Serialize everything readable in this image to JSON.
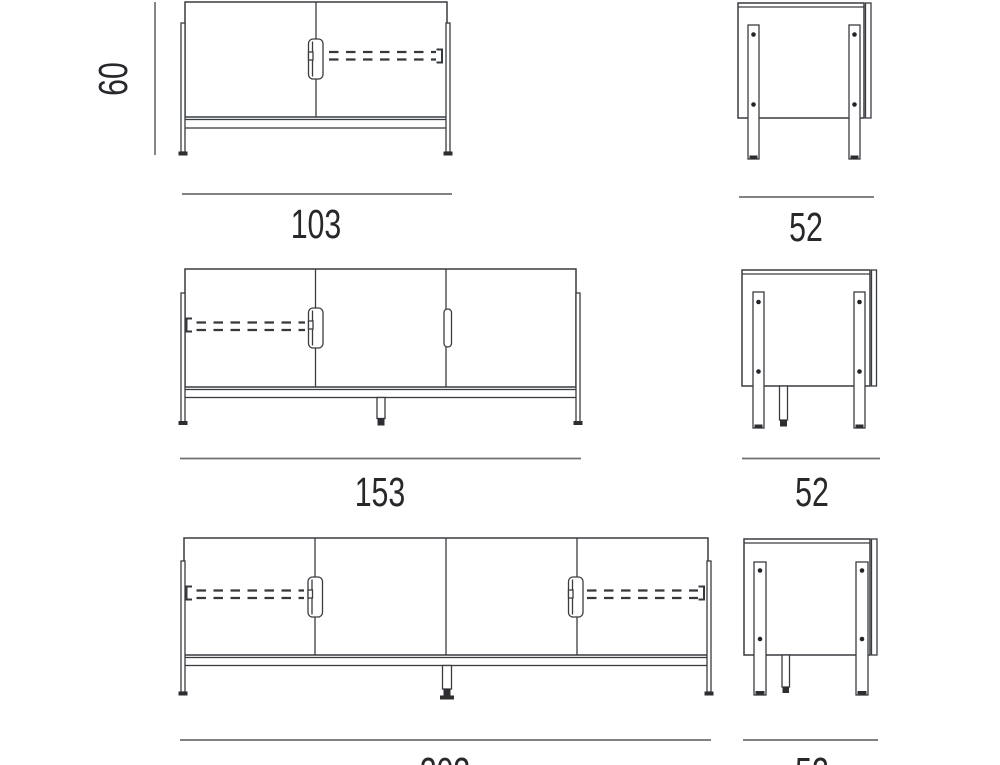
{
  "page": {
    "background": "#ffffff",
    "line_color": "#393c41",
    "dimension_line_color": "#6e7174",
    "text_color": "#26282c"
  },
  "drawing": {
    "description_units": "cm",
    "rows": [
      {
        "doors": 2,
        "front": {
          "width": "103",
          "height": "60"
        },
        "side": {
          "depth": "52"
        }
      },
      {
        "doors": 3,
        "front": {
          "width": "153"
        },
        "side": {
          "depth": "52"
        }
      },
      {
        "doors": 4,
        "front": {
          "width": "203"
        },
        "side": {
          "depth": "52"
        }
      }
    ]
  }
}
